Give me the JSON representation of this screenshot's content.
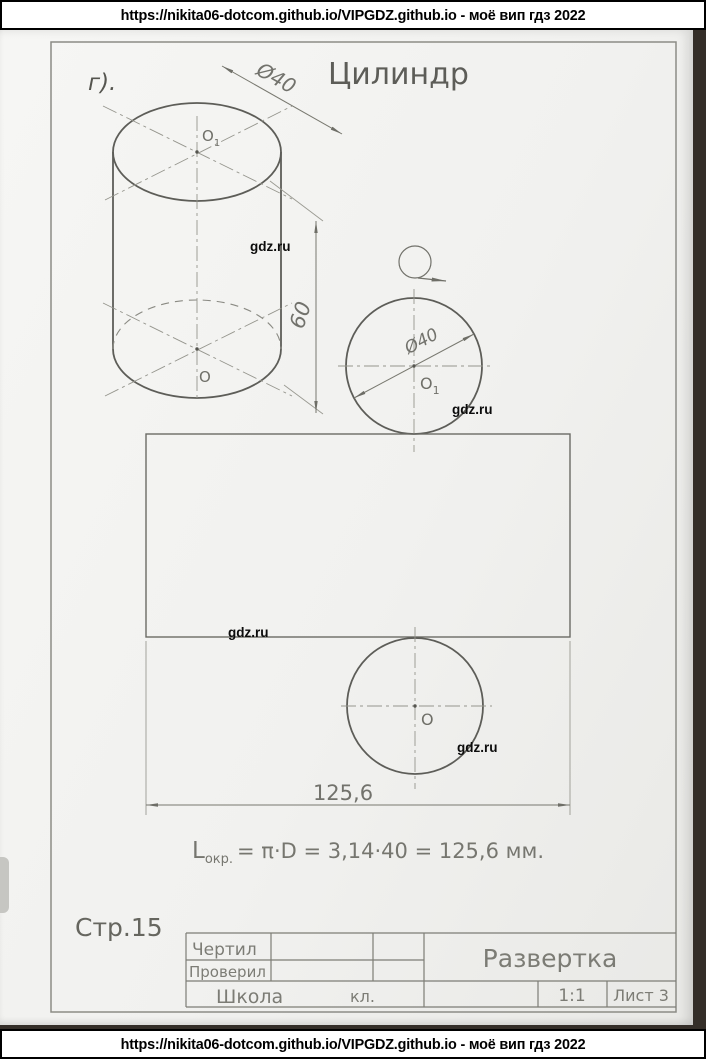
{
  "banner": {
    "text": "https://nikita06-dotcom.github.io/VIPGDZ.github.io - моё вип гдз 2022"
  },
  "watermark": "gdz.ru",
  "sheet": {
    "variant_label": "г).",
    "title": "Цилиндр",
    "page_label": "Стр.15"
  },
  "points": {
    "o": "O",
    "sub1": "1"
  },
  "dims": {
    "dia_iso": "Ø40",
    "height": "60",
    "dia_plan": "Ø40",
    "length": "125,6"
  },
  "formula": {
    "lhs": "L",
    "sub": "окр.",
    "rhs": "= π·D = 3,14·40 = 125,6 мм."
  },
  "title_block": {
    "drew": "Чертил",
    "checked": "Проверил",
    "school": "Школа",
    "class": "кл.",
    "doc_title": "Развертка",
    "scale": "1:1",
    "sheet": "Лист 3"
  }
}
